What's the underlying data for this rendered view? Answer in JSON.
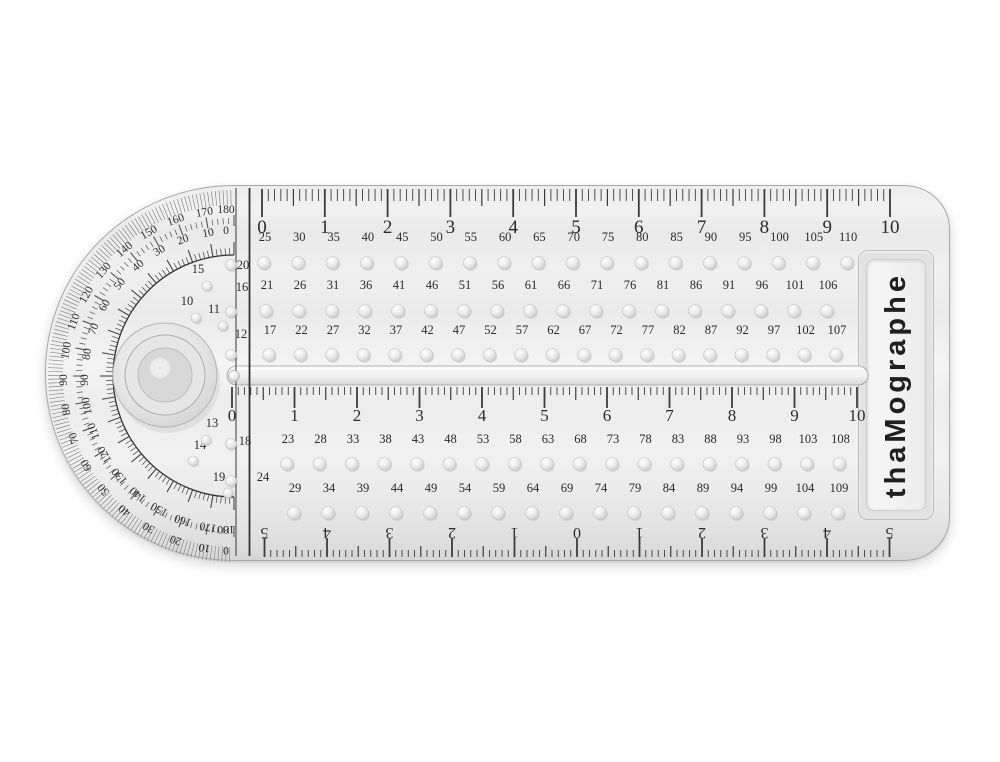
{
  "brand": {
    "label": "thaMographe"
  },
  "scales": {
    "top_cm": [
      "0",
      "1",
      "2",
      "3",
      "4",
      "5",
      "6",
      "7",
      "8",
      "9",
      "10"
    ],
    "middle_cm": [
      "0",
      "1",
      "2",
      "3",
      "4",
      "5",
      "6",
      "7",
      "8",
      "9",
      "10"
    ],
    "bottom_centering_cm": [
      "5",
      "4",
      "3",
      "2",
      "1",
      "0",
      "1",
      "2",
      "3",
      "4",
      "5"
    ]
  },
  "hole_rows": [
    {
      "name": "hole-row-1",
      "values": [
        "25",
        "30",
        "35",
        "40",
        "45",
        "50",
        "55",
        "60",
        "65",
        "70",
        "75",
        "80",
        "85",
        "90",
        "95",
        "100",
        "105",
        "110"
      ]
    },
    {
      "name": "hole-row-2",
      "values": [
        "21",
        "26",
        "31",
        "36",
        "41",
        "46",
        "51",
        "56",
        "61",
        "66",
        "71",
        "76",
        "81",
        "86",
        "91",
        "96",
        "101",
        "106"
      ]
    },
    {
      "name": "hole-row-3",
      "values": [
        "17",
        "22",
        "27",
        "32",
        "37",
        "42",
        "47",
        "52",
        "57",
        "62",
        "67",
        "72",
        "77",
        "82",
        "87",
        "92",
        "97",
        "102",
        "107"
      ]
    },
    {
      "name": "hole-row-4",
      "values": [
        "23",
        "28",
        "33",
        "38",
        "43",
        "48",
        "53",
        "58",
        "63",
        "68",
        "73",
        "78",
        "83",
        "88",
        "93",
        "98",
        "103",
        "108"
      ]
    },
    {
      "name": "hole-row-5",
      "values": [
        "29",
        "34",
        "39",
        "44",
        "49",
        "54",
        "59",
        "64",
        "69",
        "74",
        "79",
        "84",
        "89",
        "94",
        "99",
        "104",
        "109"
      ]
    }
  ],
  "left_column": {
    "upper": [
      "20",
      "16",
      "12"
    ],
    "lower": [
      "18",
      "24"
    ]
  },
  "pivot_holes": {
    "upper": [
      "15",
      "10",
      "11"
    ],
    "lower": [
      "13",
      "14",
      "19"
    ]
  },
  "protractor": {
    "outer_scale": [
      "180",
      "170",
      "160",
      "150",
      "140",
      "130",
      "120",
      "110",
      "100",
      "90",
      "80",
      "70",
      "60",
      "50",
      "40",
      "30",
      "20",
      "10",
      "0"
    ],
    "inner_scale": [
      "0",
      "10",
      "20",
      "30",
      "40",
      "50",
      "60",
      "70",
      "80",
      "90",
      "100",
      "110",
      "120",
      "130",
      "140",
      "150",
      "160",
      "170",
      "180"
    ]
  },
  "colors": {
    "body": "#ebebeb",
    "ink": "#2b2b2b",
    "tick": "#3c3c3c",
    "hole_rim": "#c4c4c4"
  }
}
